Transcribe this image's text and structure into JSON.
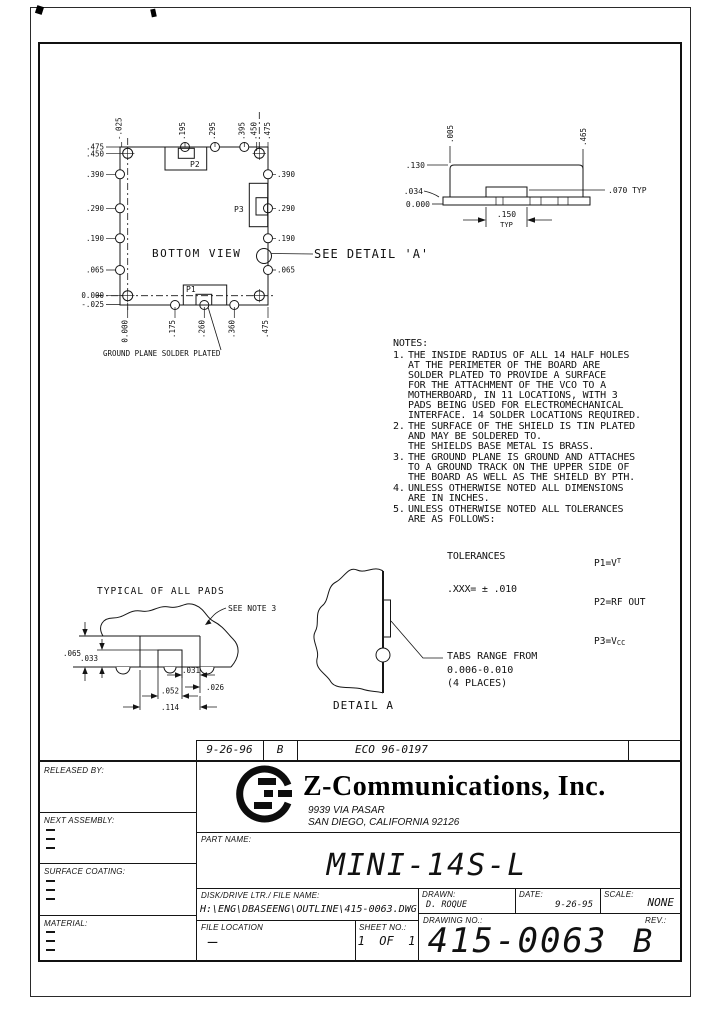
{
  "bottom_view": {
    "title": "BOTTOM VIEW",
    "caption": "GROUND PLANE SOLDER PLATED",
    "see_detail": "SEE DETAIL 'A'",
    "pad_p1": "P1",
    "pad_p2": "P2",
    "pad_p3": "P3",
    "top_dims": [
      "-.025",
      ".195",
      ".295",
      ".395",
      ".450",
      ".475"
    ],
    "left_dims": [
      ".475",
      ".450",
      ".390",
      ".290",
      ".190",
      ".065",
      "0.000",
      "-.025"
    ],
    "right_dims": [
      ".390",
      ".290",
      ".190",
      ".065"
    ],
    "bottom_dims": [
      "0.000",
      ".175",
      ".260",
      ".360",
      ".475"
    ]
  },
  "side_view": {
    "d005": ".005",
    "d465": ".465",
    "d130": ".130",
    "d034": ".034",
    "zero": "0.000",
    "d070": ".070 TYP",
    "d150": ".150",
    "typ": "TYP"
  },
  "notes": {
    "title": "NOTES:",
    "items": [
      {
        "num": "1.",
        "text": "THE INSIDE RADIUS OF ALL 14 HALF HOLES\nAT THE PERIMETER OF THE BOARD ARE\nSOLDER PLATED TO PROVIDE A SURFACE\nFOR THE ATTACHMENT OF THE VCO TO A\nMOTHERBOARD, IN 11 LOCATIONS, WITH 3\nPADS BEING USED FOR ELECTROMECHANICAL\nINTERFACE. 14 SOLDER LOCATIONS REQUIRED."
      },
      {
        "num": "2.",
        "text": "THE SURFACE OF THE SHIELD IS TIN PLATED\nAND MAY BE SOLDERED TO.\nTHE SHIELDS BASE METAL IS BRASS."
      },
      {
        "num": "3.",
        "text": "THE GROUND PLANE IS GROUND AND ATTACHES\nTO A GROUND TRACK ON THE UPPER SIDE OF\nTHE BOARD AS WELL AS THE SHIELD BY PTH."
      },
      {
        "num": "4.",
        "text": "UNLESS OTHERWISE NOTED ALL DIMENSIONS\nARE IN INCHES."
      },
      {
        "num": "5.",
        "text": "UNLESS OTHERWISE NOTED ALL TOLERANCES\nARE AS FOLLOWS:"
      }
    ],
    "tol_label": "TOLERANCES",
    "tol_value": ".XXX= ± .010"
  },
  "pin_legend": {
    "p1_base": "P1=V",
    "p1_sub": "T",
    "p2": "P2=RF OUT",
    "p3_base": "P3=V",
    "p3_sub": "CC"
  },
  "pads_detail": {
    "title": "TYPICAL OF ALL PADS",
    "note_ref": "SEE NOTE 3",
    "d065": ".065",
    "d033": ".033",
    "d031": ".031",
    "d026": ".026",
    "d052": ".052",
    "d114": ".114"
  },
  "detail_a": {
    "title": "DETAIL A",
    "callout": "TABS RANGE FROM\n0.006-0.010\n(4 PLACES)"
  },
  "eco_row": {
    "date": "9-26-96",
    "rev": "B",
    "eco": "ECO 96-0197"
  },
  "title_block": {
    "released_by": "RELEASED BY:",
    "next_assembly": "NEXT ASSEMBLY:",
    "surface_coating": "SURFACE COATING:",
    "material": "MATERIAL:",
    "company": "Z-Communications, Inc.",
    "address1": "9939 VIA PASAR",
    "address2": "SAN DIEGO, CALIFORNIA 92126",
    "part_name_label": "PART NAME:",
    "part_name": "MINI-14S-L",
    "file_label": "DISK/DRIVE LTR./ FILE NAME:",
    "file_path": "H:\\ENG\\DBASEENG\\OUTLINE\\415-0063.DWG",
    "drawn_label": "DRAWN:",
    "drawn_by": "D. ROQUE",
    "date_label": "DATE:",
    "date": "9-26-95",
    "scale_label": "SCALE:",
    "scale": "NONE",
    "file_location_label": "FILE LOCATION",
    "file_location": "—",
    "sheet_label": "SHEET NO.:",
    "sheet": "1  OF  1",
    "drawing_no_label": "DRAWING NO.:",
    "drawing_no": "415-0063",
    "rev_label": "REV.:",
    "rev": "B"
  }
}
